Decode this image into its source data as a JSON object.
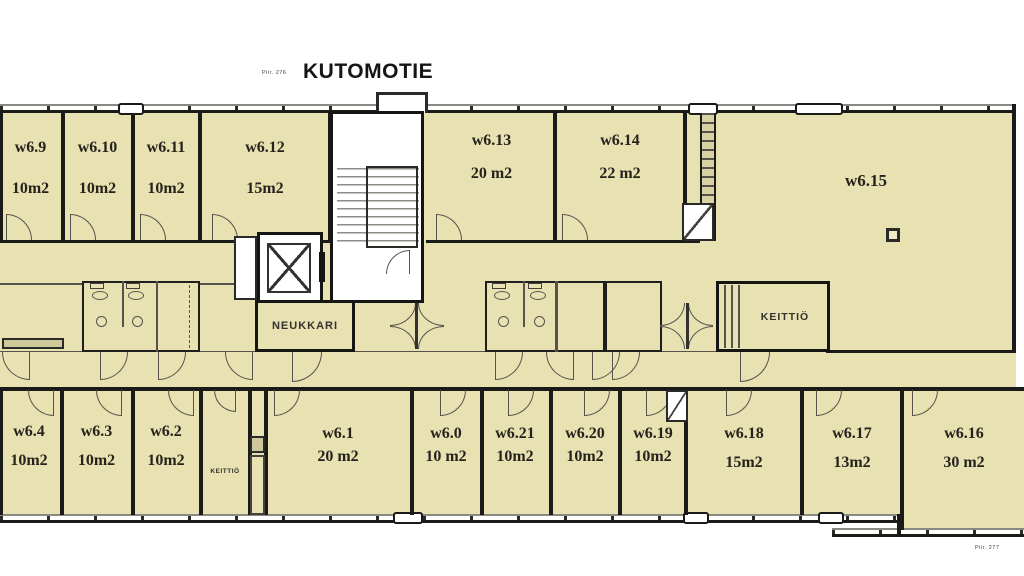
{
  "title": {
    "prefix": "Piir. 276",
    "main": "KUTOMOTIE"
  },
  "footnote": "Piir. 277",
  "core_labels": {
    "neukkari": "NEUKKARI",
    "keittio": "KEITTIÖ",
    "keittio_small": "KEITTIÖ"
  },
  "rooms_top": [
    {
      "id": "w6.9",
      "area": "10m2"
    },
    {
      "id": "w6.10",
      "area": "10m2"
    },
    {
      "id": "w6.11",
      "area": "10m2"
    },
    {
      "id": "w6.12",
      "area": "15m2"
    },
    {
      "id": "w6.13",
      "area": "20 m2"
    },
    {
      "id": "w6.14",
      "area": "22 m2"
    },
    {
      "id": "w6.15",
      "area": ""
    }
  ],
  "rooms_bottom": [
    {
      "id": "w6.4",
      "area": "10m2"
    },
    {
      "id": "w6.3",
      "area": "10m2"
    },
    {
      "id": "w6.2",
      "area": "10m2"
    },
    {
      "id": "w6.1",
      "area": "20 m2"
    },
    {
      "id": "w6.0",
      "area": "10 m2"
    },
    {
      "id": "w6.21",
      "area": "10m2"
    },
    {
      "id": "w6.20",
      "area": "10m2"
    },
    {
      "id": "w6.19",
      "area": "10m2"
    },
    {
      "id": "w6.18",
      "area": "15m2"
    },
    {
      "id": "w6.17",
      "area": "13m2"
    },
    {
      "id": "w6.16",
      "area": "30 m2"
    }
  ],
  "colors": {
    "room_fill": "#e8e1b2",
    "wall": "#1a1a19",
    "detail_line": "#55534b",
    "background": "#ffffff"
  }
}
